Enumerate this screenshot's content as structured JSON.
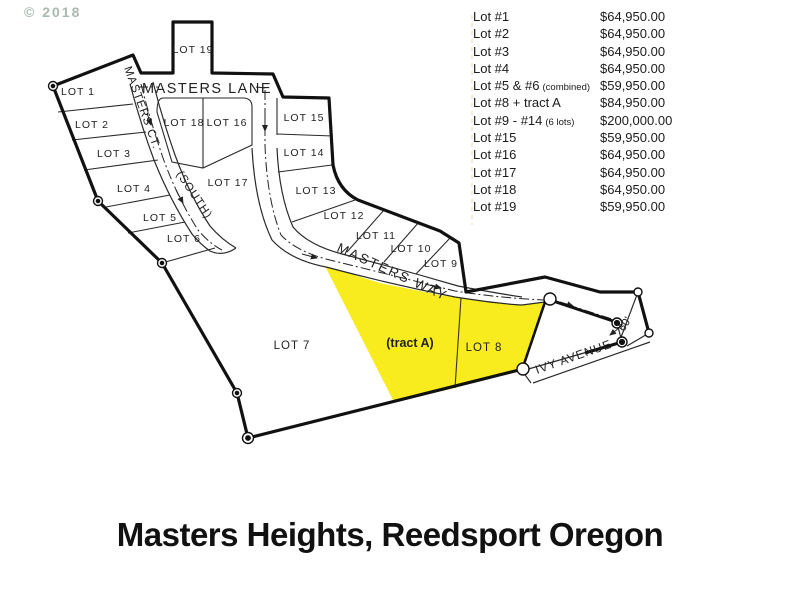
{
  "watermark": "© 2018",
  "title": "Masters Heights, Reedsport Oregon",
  "price_list": {
    "rows": [
      {
        "label": "Lot #1",
        "note": "",
        "price": "$64,950.00"
      },
      {
        "label": "Lot #2",
        "note": "",
        "price": "$64,950.00"
      },
      {
        "label": "Lot #3",
        "note": "",
        "price": "$64,950.00"
      },
      {
        "label": "Lot #4",
        "note": "",
        "price": "$64,950.00"
      },
      {
        "label": "Lot #5 & #6",
        "note": "(combined)",
        "price": "$59,950.00"
      },
      {
        "label": "Lot #8 + tract A",
        "note": "",
        "price": "$84,950.00"
      },
      {
        "label": "Lot #9 - #14",
        "note": "(6 lots)",
        "price": "$200,000.00"
      },
      {
        "label": "Lot #15",
        "note": "",
        "price": "$59,950.00"
      },
      {
        "label": "Lot #16",
        "note": "",
        "price": "$64,950.00"
      },
      {
        "label": "Lot #17",
        "note": "",
        "price": "$64,950.00"
      },
      {
        "label": "Lot #18",
        "note": "",
        "price": "$64,950.00"
      },
      {
        "label": "Lot #19",
        "note": "",
        "price": "$59,950.00"
      }
    ]
  },
  "map": {
    "lots": [
      "LOT 1",
      "LOT 2",
      "LOT 3",
      "LOT 4",
      "LOT 5",
      "LOT 6",
      "LOT 7",
      "LOT 8",
      "LOT 9",
      "LOT 10",
      "LOT 11",
      "LOT 12",
      "LOT 13",
      "LOT 14",
      "LOT 15",
      "LOT 16",
      "LOT 17",
      "LOT 18",
      "LOT 19",
      "(tract A)"
    ],
    "roads": {
      "masters_lane": "MASTERS LANE",
      "masters_ct": "MASTERS CT.",
      "masters_ct_suffix": "(SOUTH)",
      "masters_way": "MASTERS WAY",
      "ivy_avenue": "IVY AVENUE",
      "road_width": "60'"
    },
    "highlight_color": "#f8ec1e",
    "line_color": "#161616"
  }
}
